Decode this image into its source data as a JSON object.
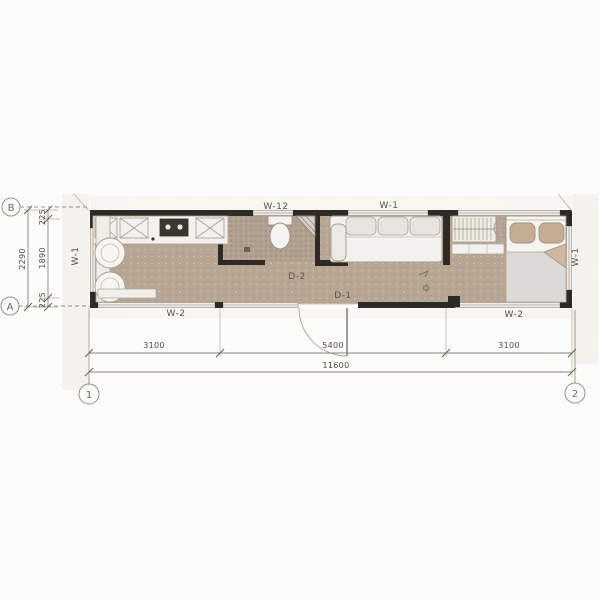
{
  "plan": {
    "type": "architectural-floor-plan",
    "axis_markers": {
      "b": "B",
      "a": "A",
      "one": "1",
      "two": "2"
    },
    "wall_labels": {
      "w12_top": "W-12",
      "w1_top": "W-1",
      "w1_left": "W-1",
      "w1_right": "W-1",
      "w2_bottom_left": "W-2",
      "w2_bottom_right": "W-2"
    },
    "door_labels": {
      "d1": "D-1",
      "d2": "D-2"
    },
    "dimensions": {
      "bottom_row": [
        "3100",
        "5400",
        "3100"
      ],
      "bottom_total": "11600",
      "left_overall": "2290",
      "left_segments": [
        "225",
        "1890",
        "225"
      ]
    },
    "colors": {
      "paper": "#fcfcfb",
      "floor": "#b8a695",
      "bathroom_floor": "#b0a08f",
      "wall": "#2e2b27",
      "dimension_line": "#8d8274",
      "furniture_fill": "#f3f2ee",
      "furniture_stroke": "#a29a8c",
      "pillow": "#c3ad95"
    },
    "rooms": {
      "kitchen": "kitchen",
      "bathroom": "bathroom",
      "living": "living-area",
      "bedroom": "bedroom"
    }
  }
}
